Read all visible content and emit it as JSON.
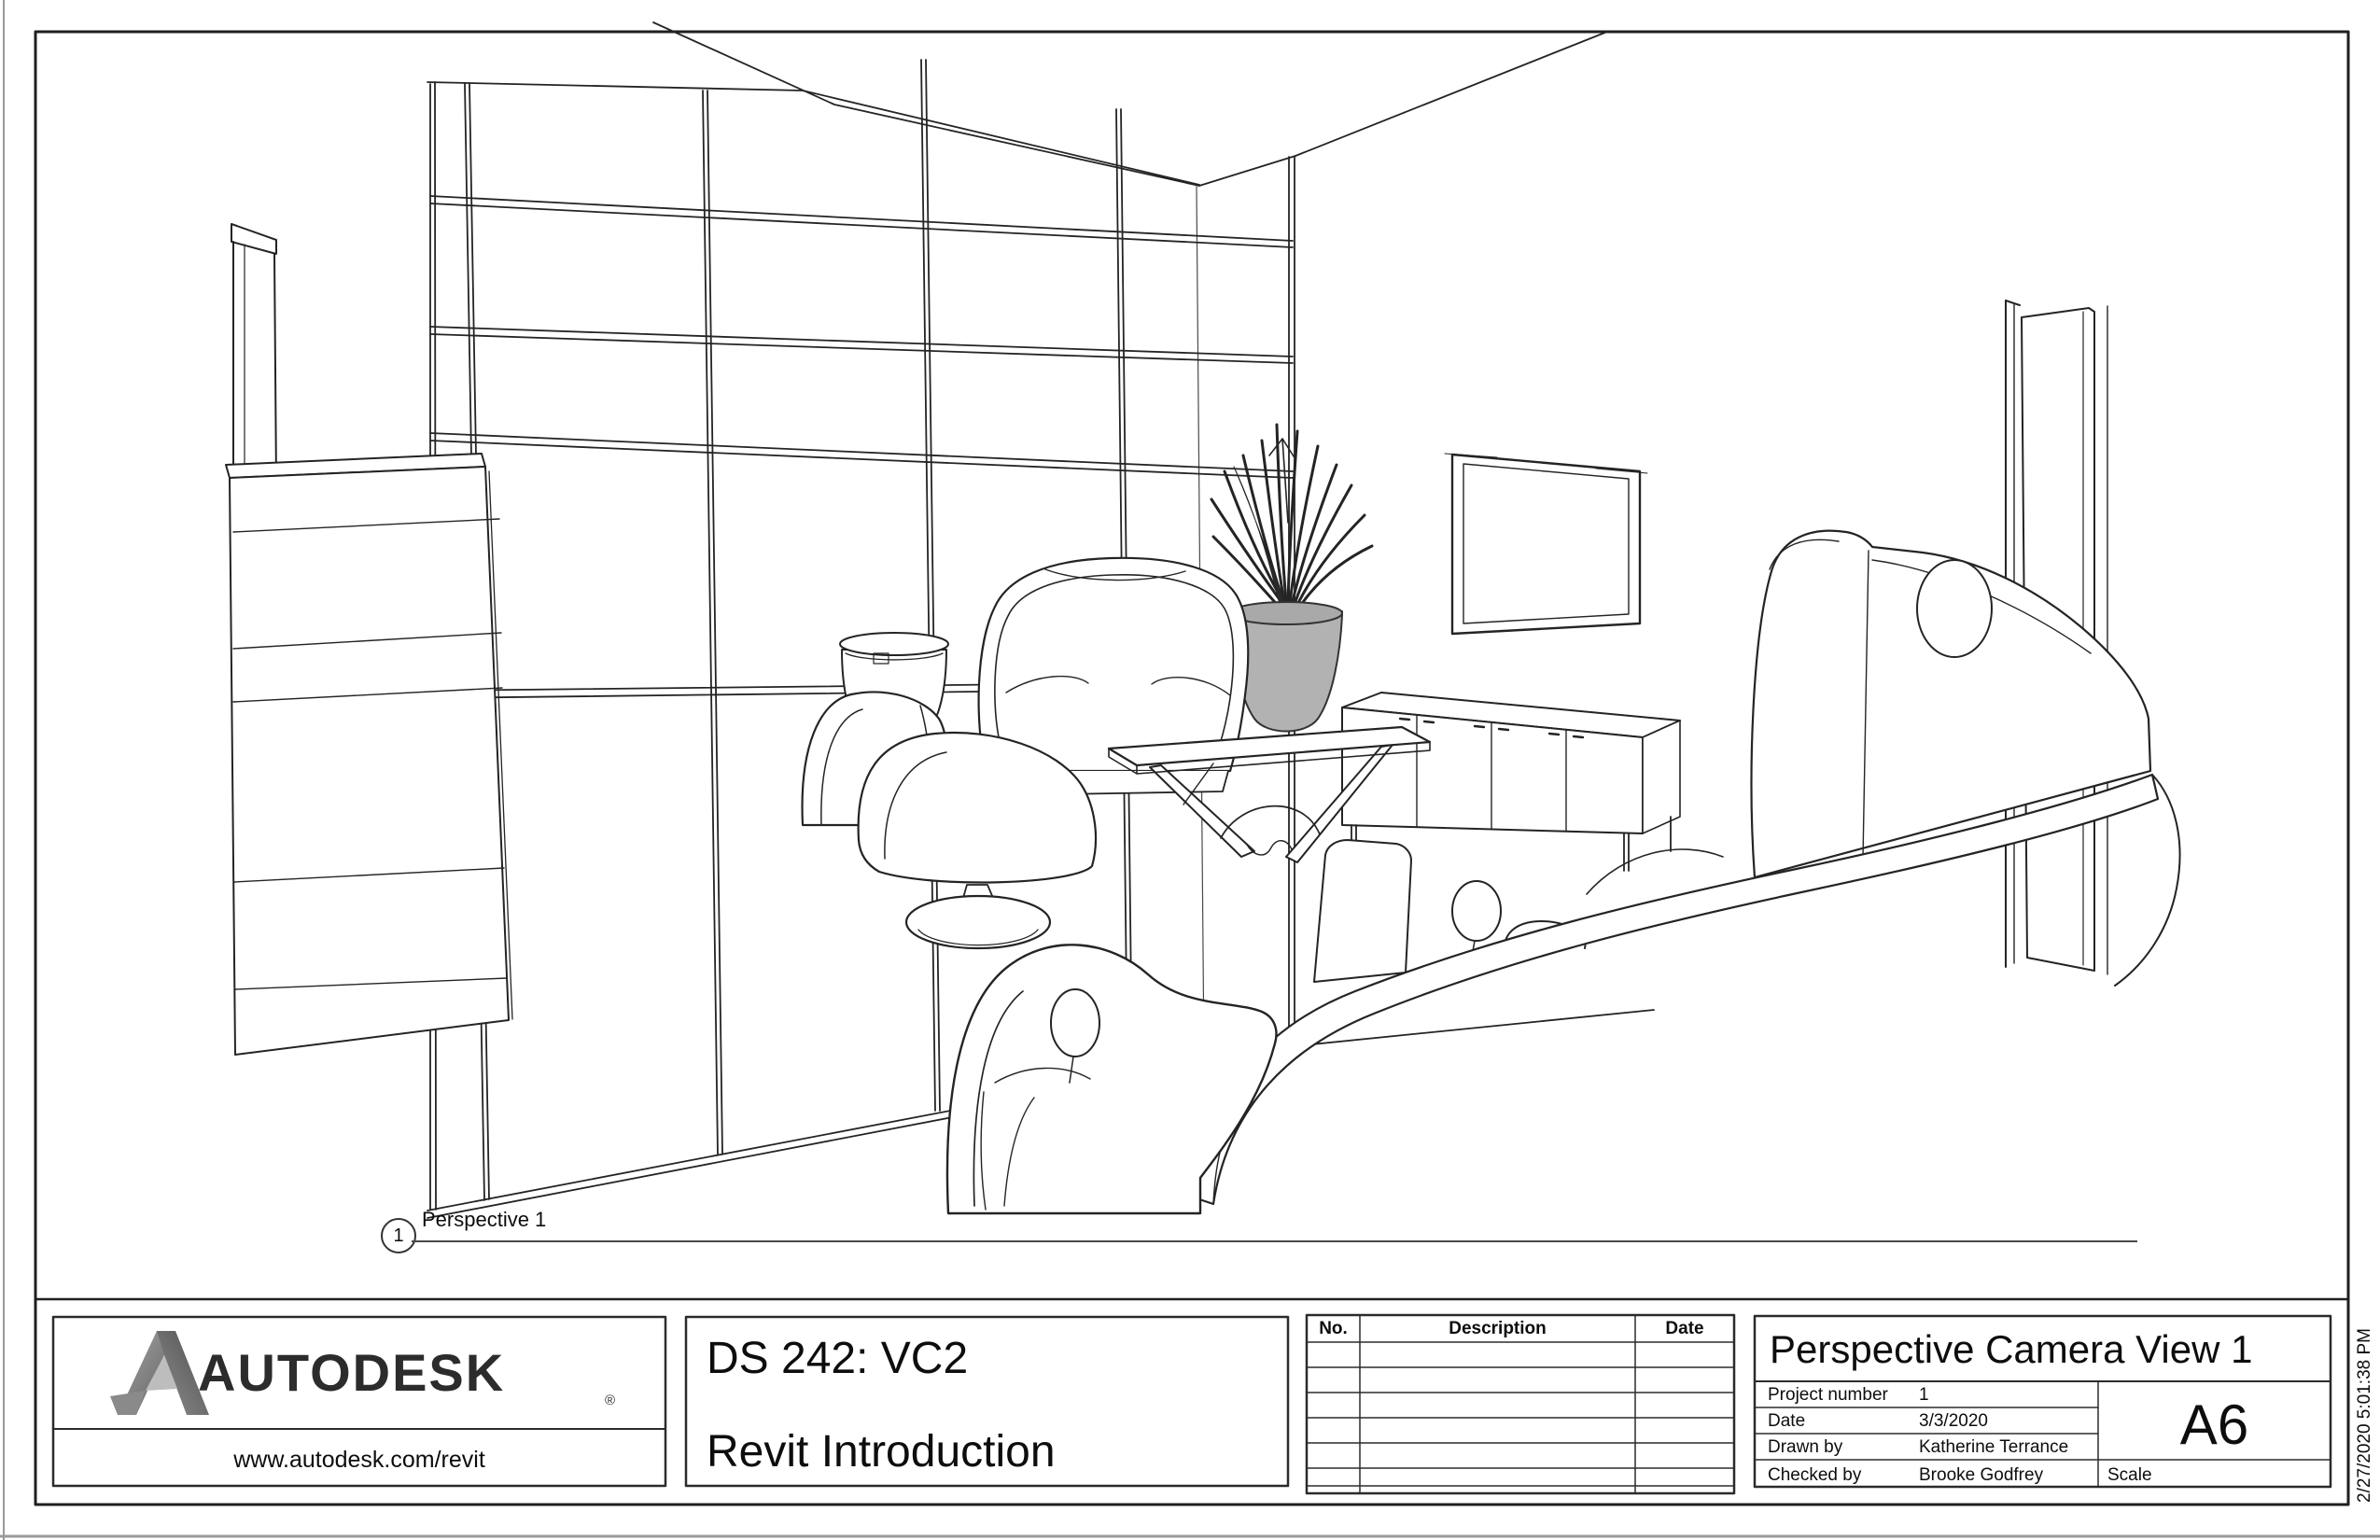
{
  "sheet": {
    "view_label": {
      "number": "1",
      "name": "Perspective 1"
    },
    "timestamp": "2/27/2020 5:01:38 PM"
  },
  "title_block": {
    "logo": {
      "brand": "AUTODESK",
      "registered": "®",
      "url": "www.autodesk.com/revit"
    },
    "project": {
      "course": "DS 242: VC2",
      "title": "Revit Introduction"
    },
    "revision_table": {
      "headers": [
        "No.",
        "Description",
        "Date"
      ],
      "empty_rows": 7
    },
    "info": {
      "title": "Perspective Camera View 1",
      "fields": [
        {
          "label": "Project number",
          "value": "1"
        },
        {
          "label": "Date",
          "value": "3/3/2020"
        },
        {
          "label": "Drawn by",
          "value": "Katherine Terrance"
        },
        {
          "label": "Checked by",
          "value": "Brooke Godfrey"
        }
      ],
      "sheet_number": "A6",
      "scale_label": "Scale",
      "scale_value": ""
    }
  },
  "colors": {
    "line": "#242424",
    "sheet_border": "#1f1f1f",
    "block_border": "#2b2b2b",
    "pot_fill": "#b2b2b2",
    "logo_dark": "#2c2c2c",
    "logo_gradient_start": "#a6a6a6",
    "logo_gradient_end": "#5e5e5e",
    "page_edge": "#9a9a9a"
  }
}
